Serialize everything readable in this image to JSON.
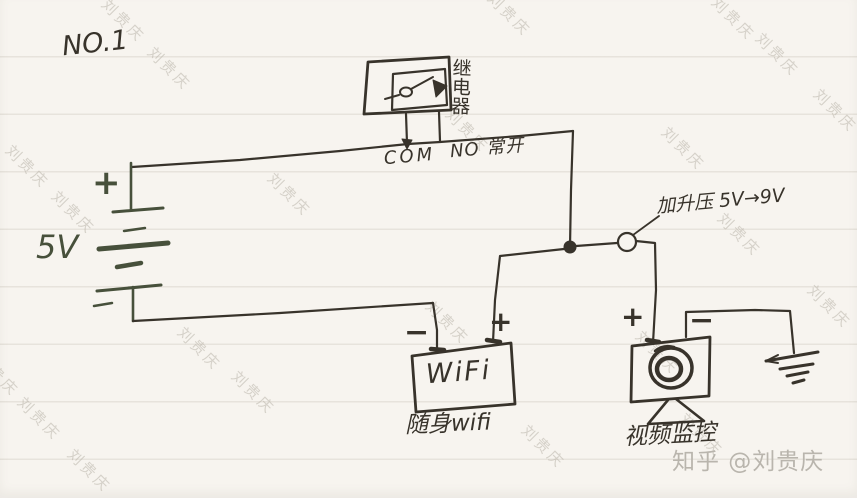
{
  "colors": {
    "ink": "#38332b",
    "battery_ink": "#47503b",
    "paper": "#f7f4ef",
    "watermark": "#bab4aa",
    "credit_gray": "#b9b5ad"
  },
  "page": {
    "note_number": "NO.1",
    "watermark_text": "刘贵庆",
    "credit": "知乎 @刘贵庆"
  },
  "relay": {
    "label": "继电器",
    "com_label": "COM",
    "no_label": "NO 常开"
  },
  "battery": {
    "voltage": "5V",
    "plus_sign": "+"
  },
  "boost": {
    "annotation": "加升压 5V→9V"
  },
  "wifi": {
    "device_text": "WiFi",
    "caption": "随身wifi",
    "plus_sign": "+",
    "minus_sign": "−"
  },
  "camera": {
    "caption": "视频监控",
    "plus_sign": "+",
    "minus_sign": "−"
  }
}
